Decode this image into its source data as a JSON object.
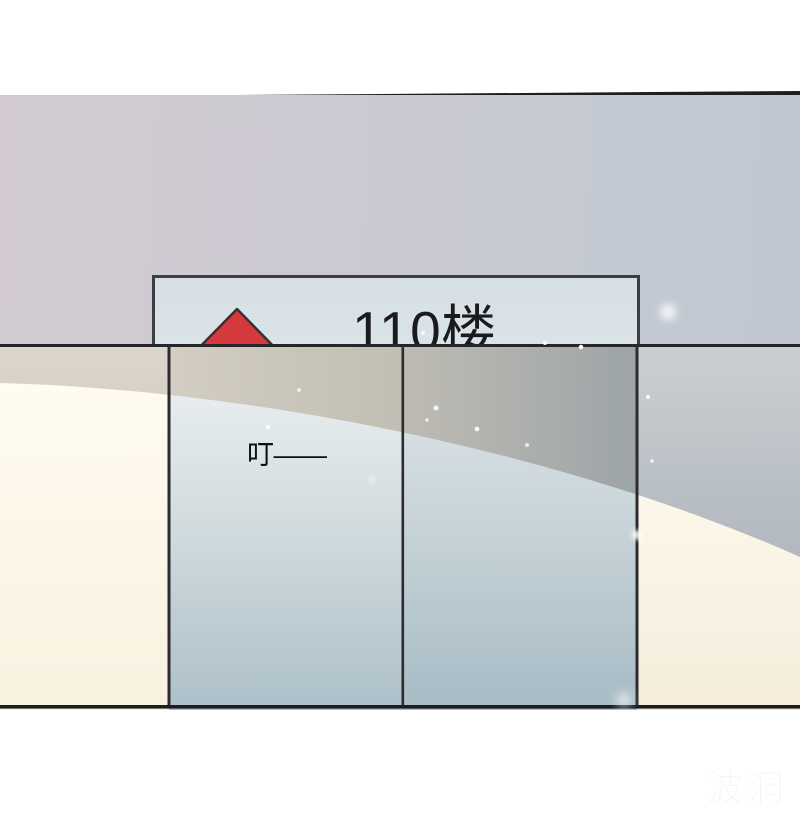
{
  "sign": {
    "floor_label": "110楼",
    "arrow_icon": "up-triangle",
    "arrow_color": "#d6393d"
  },
  "sfx": {
    "ding_text": "叮——"
  },
  "watermark": {
    "brand_text": "波洞"
  },
  "colors": {
    "accent_red": "#d6393d",
    "panel_mauve": "#d3cad3",
    "panel_blue_grey": "#c0c7d1",
    "sign_bg": "#d9e3e8",
    "sign_border": "#3e3e42",
    "wall_cream": "#fbf4e3",
    "door_glass_light": "#e9eeef",
    "door_glass_dark": "#adc0c9",
    "panel_line": "#26262a"
  }
}
